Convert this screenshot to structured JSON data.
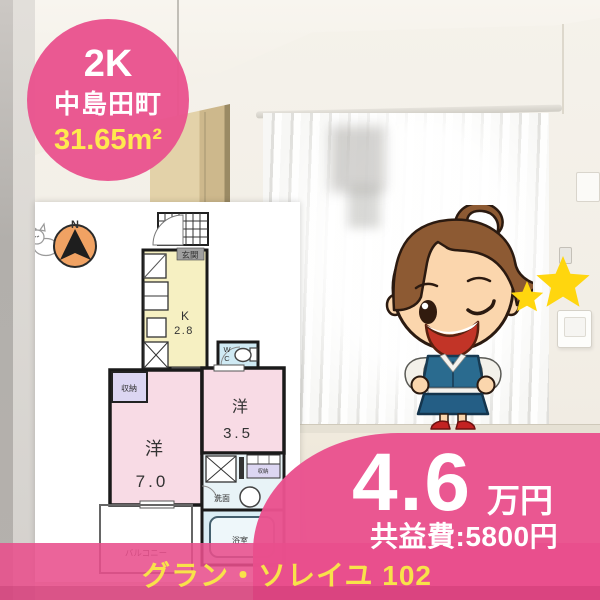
{
  "badge": {
    "layout": "2K",
    "town": "中島田町",
    "area": "31.65m²"
  },
  "floorplan": {
    "compass_label": "N",
    "entrance": "玄関",
    "kitchen": "K",
    "kitchen_size": "2.8",
    "wc_w": "W",
    "wc_c": "C",
    "closet": "収納",
    "closet_small": "収納",
    "room_main_label": "洋",
    "room_main_size": "7.0",
    "room_sub_label": "洋",
    "room_sub_size": "3.5",
    "washroom": "洗面",
    "bath": "浴室",
    "balcony": "バルコニー"
  },
  "price": {
    "rent": "4.6",
    "rent_unit": "万円",
    "common_fee": "共益費:5800円"
  },
  "property_name": "グラン・ソレイユ 102",
  "colors": {
    "accent_pink": "#e9528e",
    "highlight_yellow": "#ffe94e",
    "star_yellow": "#ffd60e"
  }
}
